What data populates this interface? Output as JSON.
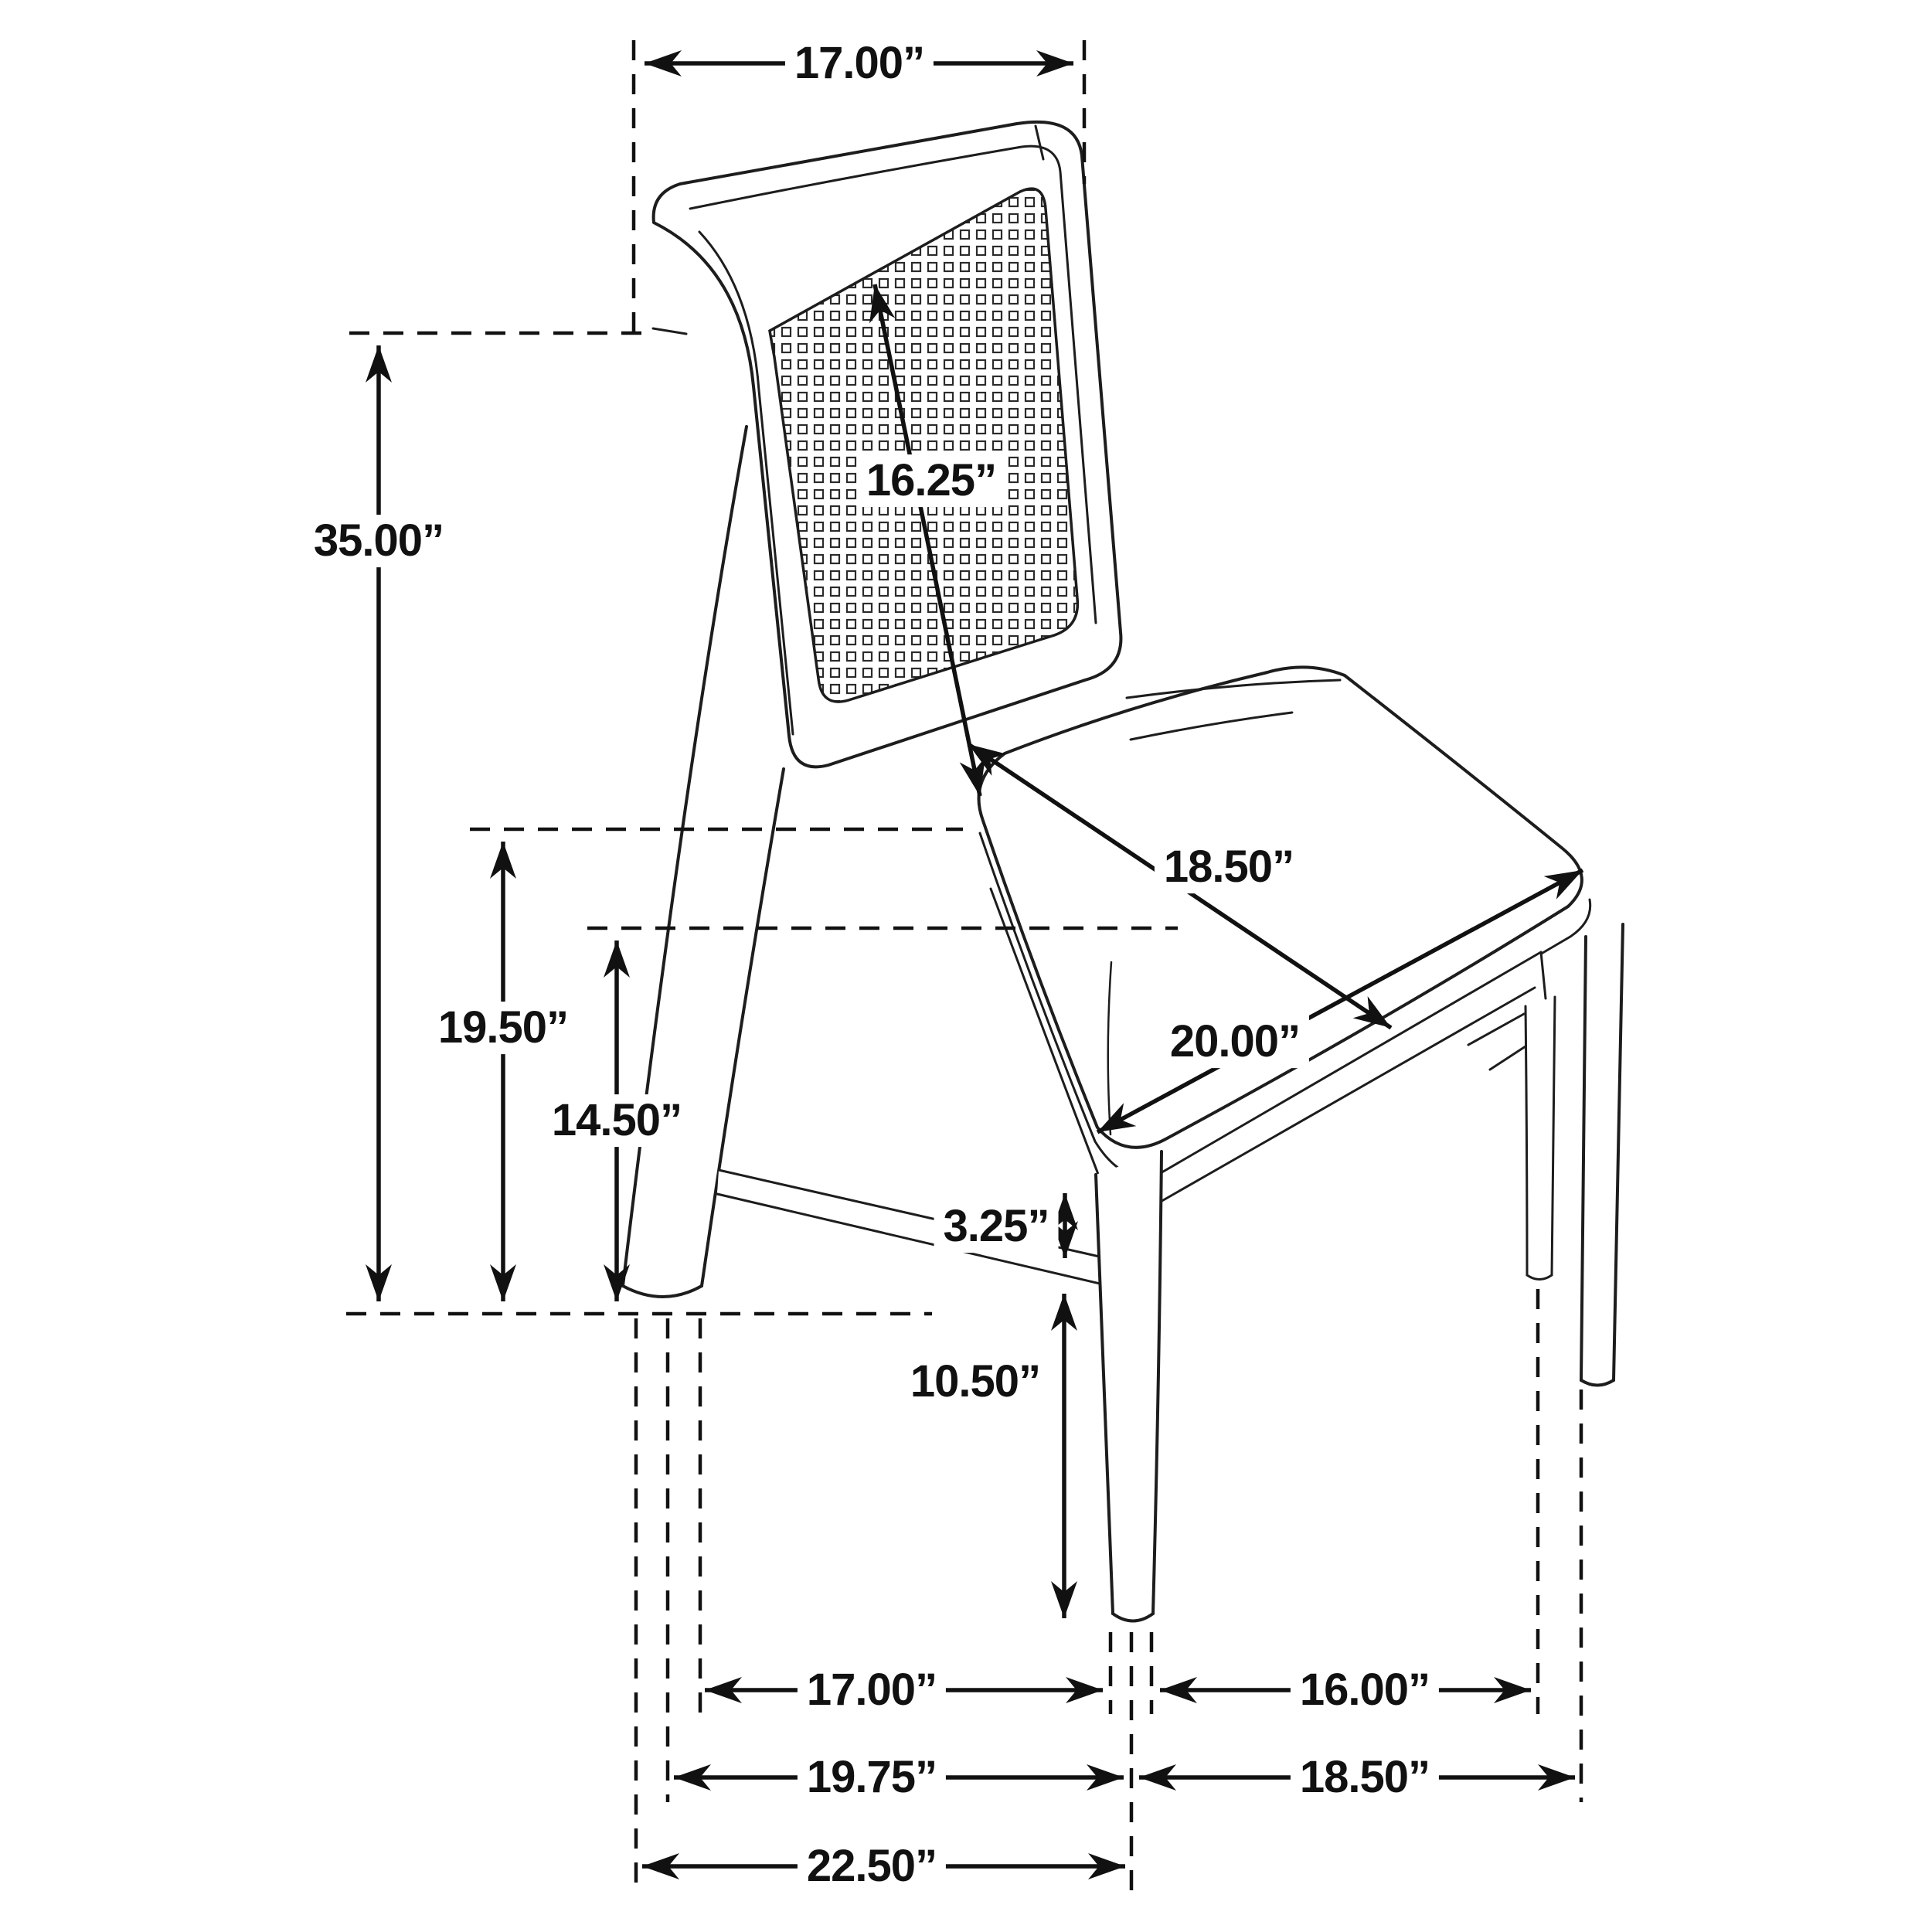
{
  "meta": {
    "subject": "Cane-back dining side chair dimension diagram",
    "unit": "inches",
    "background_color": "#ffffff",
    "line_color": "#1d1d1d"
  },
  "dims": {
    "top_back_width": "17.00”",
    "back_diagonal": "16.25”",
    "overall_height": "35.00”",
    "seat_height": "19.50”",
    "stretcher_height": "14.50”",
    "seat_depth": "18.50”",
    "seat_width": "20.00”",
    "apron_gap": "3.25”",
    "front_leg_height": "10.50”",
    "floor_span_back_to_front_leg": "17.00”",
    "floor_span_between_front_legs": "16.00”",
    "floor_span_depth_mid": "19.75”",
    "floor_span_width_outer": "18.50”",
    "overall_depth": "22.50”"
  }
}
